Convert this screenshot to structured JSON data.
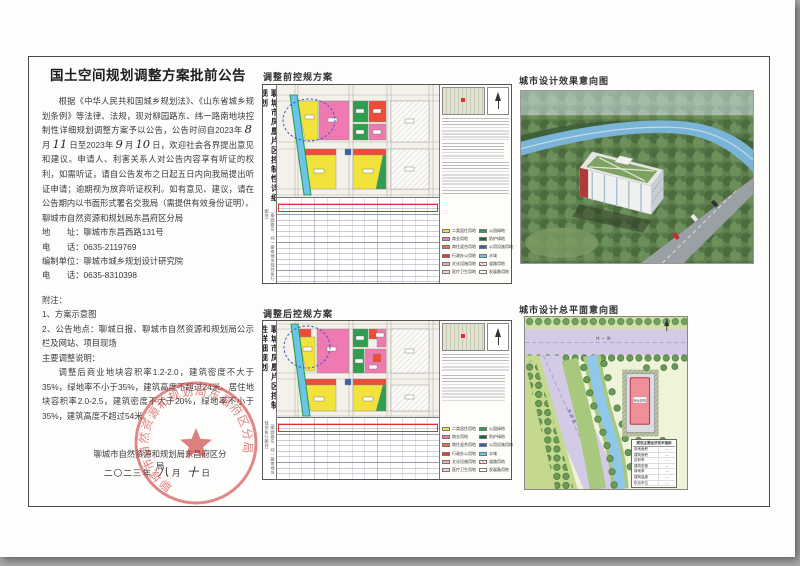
{
  "page": {
    "title": "国土空间规划调整方案批前公告"
  },
  "notice": {
    "p1a": "根据《中华人民共和国城乡规划法》、《山东省城乡规划条例》等法律、法规，现对柳园路东、纬一路南地块控制性详细规划调整方案予以公告，公告时间自2023年",
    "hw_month1": "8",
    "p1b": "月",
    "hw_day1": "11",
    "p1c": "日至2023年",
    "hw_month2": "9",
    "p1d": "月",
    "hw_day2": "10",
    "p1e": "日，欢迎社会各界提出意见和建议。申请人、利害关系人对公告内容享有听证的权利，如需听证，请自公告发布之日起五日内向我局提出听证申请；逾期视为放弃听证权利。如有意见、建议，请在公告期内以书面形式署名交我局（需提供有效身份证明）。",
    "agency": "聊城市自然资源和规划局东昌府区分局",
    "address_label": "地　　址：",
    "address_value": "聊城市东昌西路131号",
    "phone_label": "电　　话：",
    "phone_value": "0635-2119769",
    "compiler_label": "编制单位：",
    "compiler_value": "聊城市城乡规划设计研究院",
    "phone2_label": "电　　话：",
    "phone2_value": "0635-8310398",
    "notes_title": "附注：",
    "note1": "1、方案示意图",
    "note2": "2、公告地点：聊城日报、聊城市自然资源和规划局公示栏及网站、项目现场",
    "adjust_title": "主要调整说明：",
    "adjust_body": "调整后商业地块容积率1.2-2.0，建筑密度不大于35%，绿地率不小于35%，建筑高度不超过24米。居住地块容积率2.0-2.5，建筑密度不大于20%，绿地率不小于35%，建筑高度不超过54米。",
    "signature": "聊城市自然资源和规划局东昌府区分局",
    "date_year": "二〇二三年",
    "date_month_hw": "八",
    "date_month_label": "月",
    "date_day_hw": "十",
    "date_day_label": "日",
    "seal_text": "聊城市自然资源和规划局东昌府区分局"
  },
  "panels": {
    "before_label": "调整前控规方案",
    "after_label": "调整后控规方案",
    "render_label": "城市设计效果意向图",
    "siteplan_label": "城市设计总平面意向图"
  },
  "map": {
    "vertical_title": "聊城市凤凰片区控制性详细规划",
    "vertical_subtitle": "（柳园路东、纬一路南地块规划执行图则）",
    "road_label_weiyi": "纬一路",
    "road_label_liuyuan": "柳园路",
    "building_label": "商业建筑"
  },
  "siteplan_table": {
    "title": "规划主要经济技术指标",
    "rows": [
      "用地面积",
      "建筑面积",
      "容积率",
      "建筑密度",
      "绿地率",
      "建筑高度",
      "机动车位"
    ]
  },
  "legend": {
    "left": [
      {
        "color": "#f2e23c",
        "label": "二类居住用地"
      },
      {
        "color": "#ef7ab2",
        "label": "商业用地"
      },
      {
        "color": "#f0713c",
        "label": "商住混合用地"
      },
      {
        "color": "#e8392f",
        "label": "行政办公用地"
      },
      {
        "color": "#f2a6b4",
        "label": "文化设施用地"
      },
      {
        "color": "#f6cdd3",
        "label": "医疗卫生用地"
      }
    ],
    "right": [
      {
        "color": "#2f9e50",
        "label": "公园绿地"
      },
      {
        "color": "#17703a",
        "label": "防护绿地"
      },
      {
        "color": "#3a5fb0",
        "label": "公用设施用地"
      },
      {
        "color": "#6cc5e8",
        "label": "水域"
      },
      {
        "color": "hatch",
        "label": "道路用地"
      },
      {
        "color": "#ffffff",
        "label": "发展备用地"
      }
    ]
  },
  "colors": {
    "seal_red": "#cc3a3a",
    "residential_yellow": "#f2e23c",
    "commercial_pink": "#ef7ab2",
    "admin_red": "#ee4b38",
    "park_green": "#2f9e50",
    "water_cyan": "#6cc5e8",
    "road_lavender": "#d3cae6",
    "river_blue": "#8fc8ea",
    "building_pink": "#ef8f9a"
  }
}
